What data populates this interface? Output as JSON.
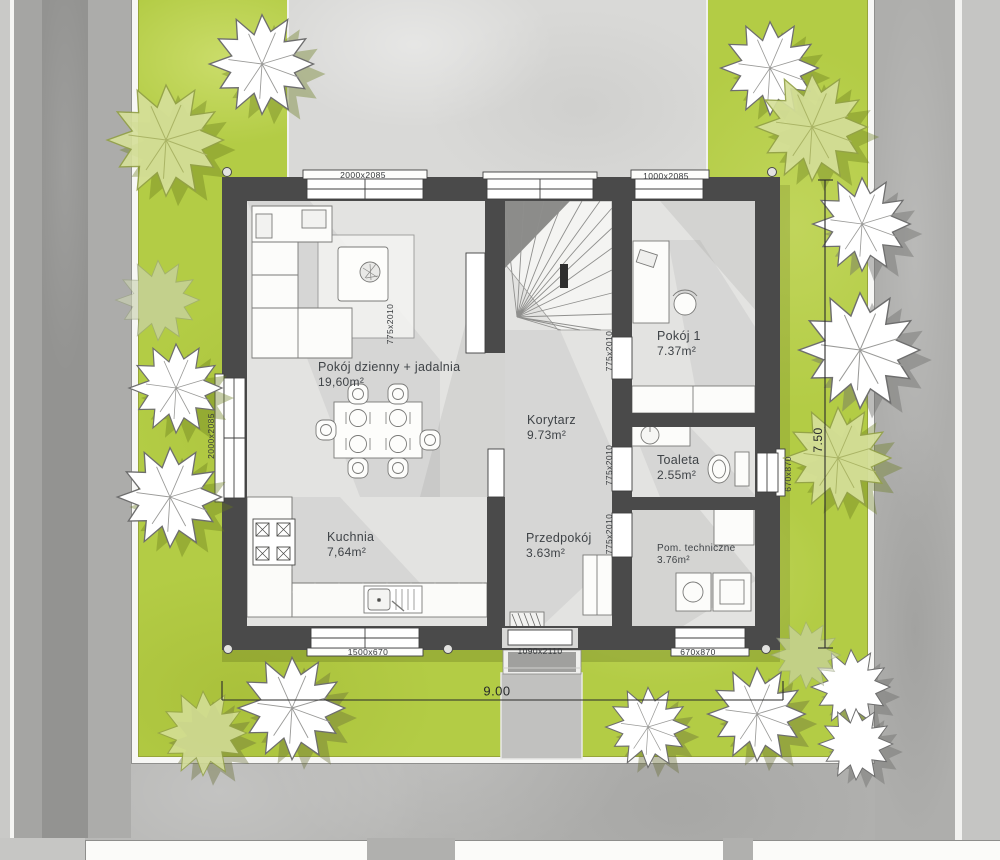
{
  "plan": {
    "rooms": [
      {
        "name": "Pokój dzienny + jadalnia",
        "area": "19,60m²"
      },
      {
        "name": "Korytarz",
        "area": "9.73m²"
      },
      {
        "name": "Pokój 1",
        "area": "7.37m²"
      },
      {
        "name": "Toaleta",
        "area": "2.55m²"
      },
      {
        "name": "Kuchnia",
        "area": "7,64m²"
      },
      {
        "name": "Przedpokój",
        "area": "3.63m²"
      },
      {
        "name": "Pom. techniczne",
        "area": "3.76m²"
      }
    ],
    "opening_labels": {
      "top_window_living": "2000x2085",
      "top_window_room1": "1000x2085",
      "left_window_living": "2000x2085",
      "living_door": "775x2010",
      "room1_door": "775x2010",
      "toilet_door": "775x2010",
      "tech_door": "775x2010",
      "right_window_toilet": "670x870",
      "bottom_window_kitchen": "1500x670",
      "entry_door": "1090x2110",
      "bottom_window_tech": "670x870"
    },
    "dimensions": {
      "total_width_m": "9.00",
      "total_depth_m": "7.50"
    },
    "colors": {
      "lawn": "#b3cc45",
      "wall": "#4a4a4a",
      "floor": "#e3e3e1",
      "driveway": "#d9d9d7",
      "paving": "#b4b4b2",
      "label_text": "#3f4347"
    }
  }
}
